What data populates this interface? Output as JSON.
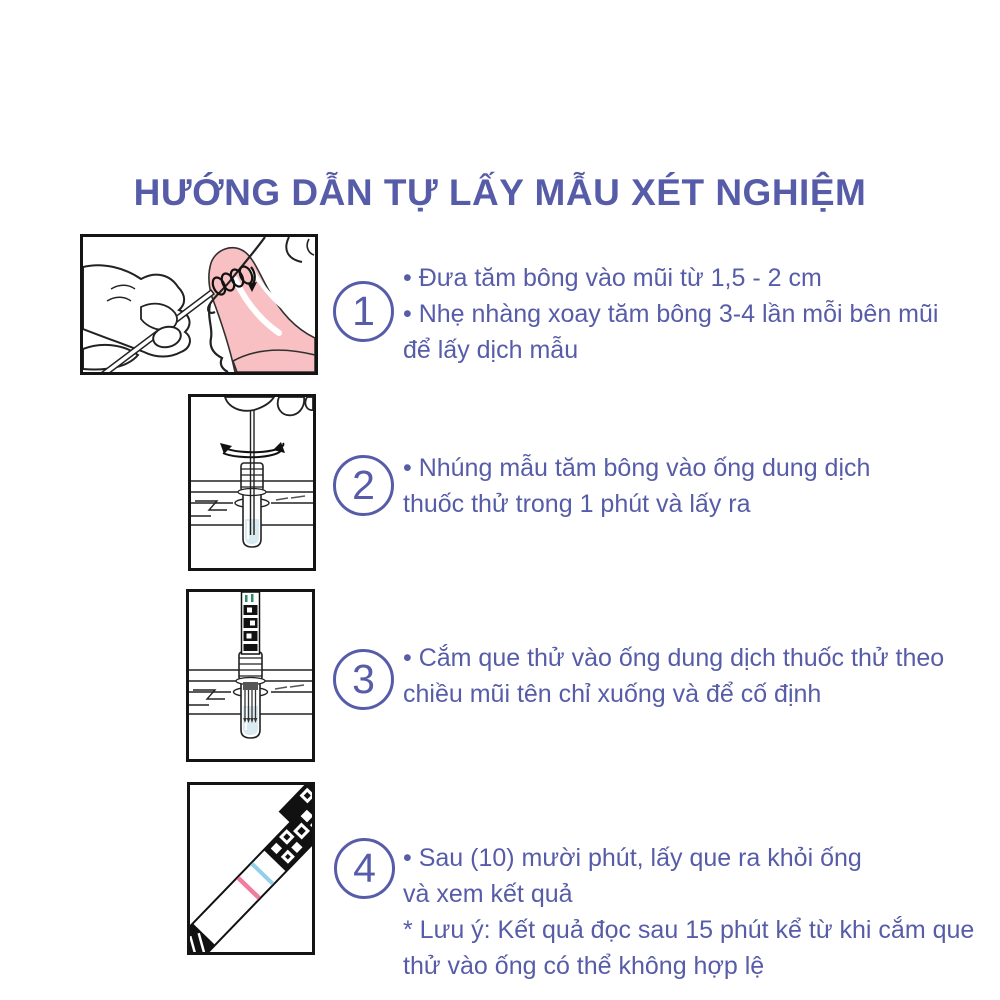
{
  "title": "HƯỚNG DẪN TỰ LẤY MẪU XÉT NGHIỆM",
  "colors": {
    "accent": "#575CA8",
    "illustration_ink": "#141414",
    "tissue_pink": "#F8C0C2",
    "liquid_blue": "#D9EAF1",
    "result_line_pink": "#F27CA0",
    "result_line_blue": "#93CFE8"
  },
  "steps": [
    {
      "number": "1",
      "illustration": "nasal-swab-illustration",
      "lines": [
        "• Đưa tăm bông vào mũi từ 1,5 - 2 cm",
        "• Nhẹ nhàng xoay tăm bông 3-4 lần mỗi bên mũi",
        "để lấy dịch mẫu"
      ]
    },
    {
      "number": "2",
      "illustration": "swab-in-tube-illustration",
      "lines": [
        "• Nhúng mẫu tăm bông vào ống dung dịch",
        "thuốc thử trong 1 phút và lấy ra"
      ]
    },
    {
      "number": "3",
      "illustration": "test-strip-in-tube-illustration",
      "lines": [
        "• Cắm que thử vào ống dung dịch thuốc thử theo",
        "chiều mũi tên chỉ xuống và để cố định"
      ]
    },
    {
      "number": "4",
      "illustration": "result-strip-illustration",
      "lines": [
        "• Sau (10) mười phút, lấy que ra khỏi ống",
        "và xem kết quả",
        "* Lưu ý: Kết quả đọc sau 15 phút kể từ khi cắm que",
        "thử vào ống có thể không hợp lệ"
      ]
    }
  ]
}
